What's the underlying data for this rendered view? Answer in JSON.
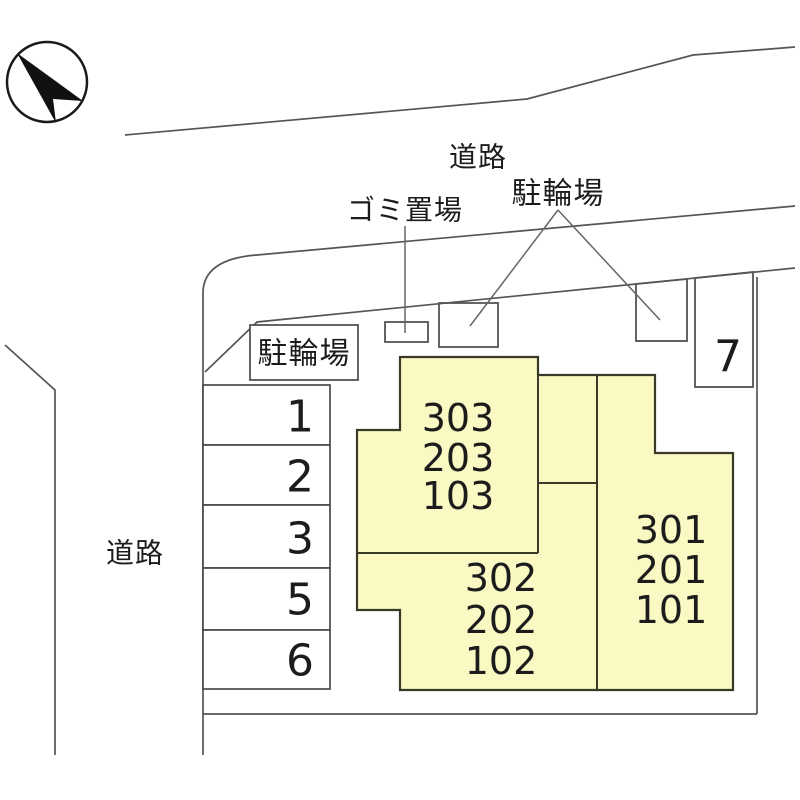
{
  "colors": {
    "building_fill": "#FBF9C3",
    "building_stroke": "#3A3A28",
    "boundary_line": "#555555",
    "box_stroke": "#4A4A4A",
    "text": "#1C1C1C"
  },
  "compass": {
    "icon": "north-arrow"
  },
  "roads": {
    "top": "道路",
    "left": "道路"
  },
  "facilities": {
    "garbage_label": "ゴミ置場",
    "bicycle_label_top": "駐輪場",
    "bicycle_label_boxed": "駐輪場"
  },
  "parking": {
    "stalls": [
      "1",
      "2",
      "3",
      "5",
      "6",
      "7"
    ]
  },
  "building": {
    "west_upper_units": [
      "303",
      "203",
      "103"
    ],
    "west_lower_units": [
      "302",
      "202",
      "102"
    ],
    "east_units": [
      "301",
      "201",
      "101"
    ]
  }
}
